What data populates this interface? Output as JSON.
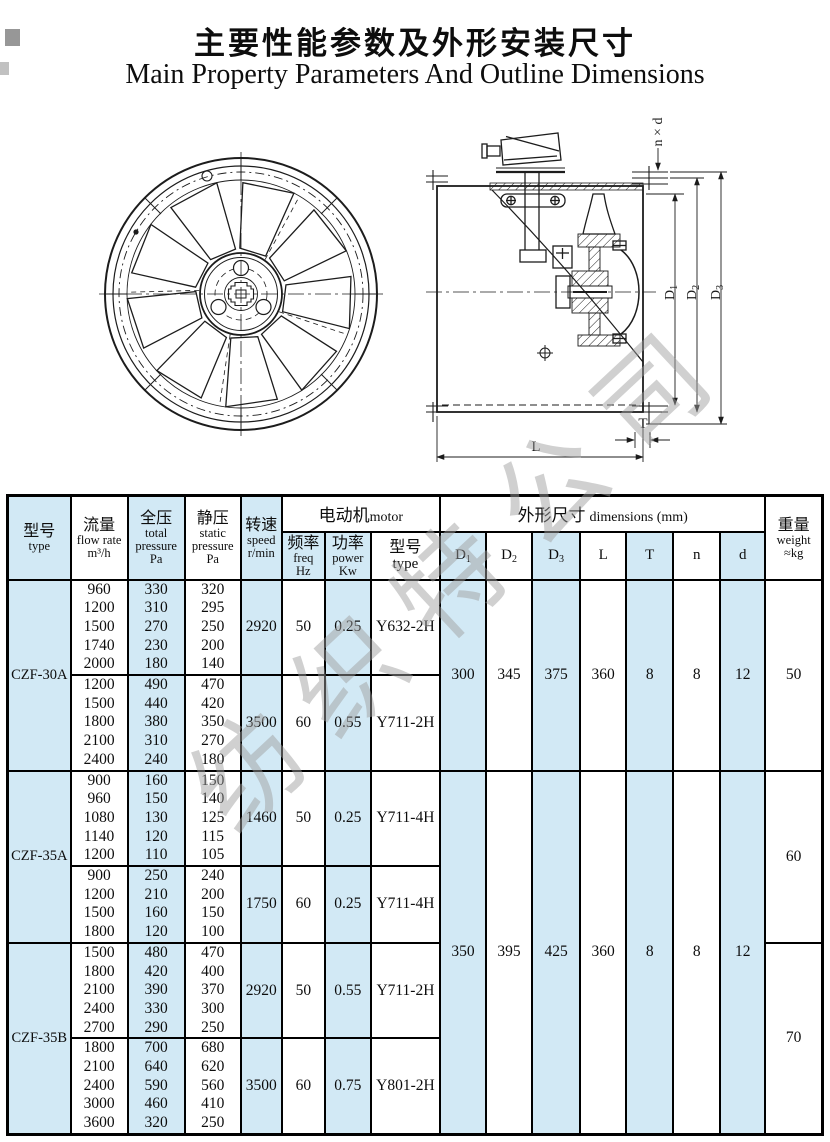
{
  "title": {
    "zh": "主要性能参数及外形安装尺寸",
    "en": "Main Property Parameters And Outline Dimensions"
  },
  "watermark": {
    "text": "纺织特公司"
  },
  "drawing_labels": {
    "nxd": "n × d",
    "l": "L",
    "t": "T"
  },
  "table": {
    "header": {
      "type_zh": "型号",
      "type_en": "type",
      "flow_zh": "流量",
      "flow_en": "flow rate",
      "flow_unit": "m³/h",
      "total_zh": "全压",
      "total_en": "total pressure",
      "total_unit": "Pa",
      "static_zh": "静压",
      "static_en": "static pressure",
      "static_unit": "Pa",
      "speed_zh": "转速",
      "speed_en": "speed",
      "speed_unit": "r/min",
      "motor_zh": "电动机",
      "motor_en": "motor",
      "freq_zh": "频率",
      "freq_en": "freq",
      "freq_unit": "Hz",
      "power_zh": "功率",
      "power_en": "power",
      "power_unit": "Kw",
      "mtype_zh": "型号",
      "mtype_en": "type",
      "dims_zh": "外形尺寸",
      "dims_en": "dimensions  (mm)",
      "d1": {
        "base": "D",
        "sub": "1"
      },
      "d2": {
        "base": "D",
        "sub": "2"
      },
      "d3": {
        "base": "D",
        "sub": "3"
      },
      "l": "L",
      "t": "T",
      "n": "n",
      "d": "d",
      "weight_zh": "重量",
      "weight_en": "weight",
      "weight_unit": "≈kg"
    },
    "groups": [
      {
        "type": "CZF-30A",
        "weight": 50,
        "blocks": [
          {
            "flow": [
              960,
              1200,
              1500,
              1740,
              2000
            ],
            "total": [
              330,
              310,
              270,
              230,
              180
            ],
            "static": [
              320,
              295,
              250,
              200,
              140
            ],
            "speed": 2920,
            "freq": 50,
            "power": "0.25",
            "motor": "Y632-2H"
          },
          {
            "flow": [
              1200,
              1500,
              1800,
              2100,
              2400
            ],
            "total": [
              490,
              440,
              380,
              310,
              240
            ],
            "static": [
              470,
              420,
              350,
              270,
              180
            ],
            "speed": 3500,
            "freq": 60,
            "power": "0.55",
            "motor": "Y711-2H"
          }
        ]
      },
      {
        "type": "CZF-35A",
        "weight": 60,
        "blocks": [
          {
            "flow": [
              900,
              960,
              1080,
              1140,
              1200
            ],
            "total": [
              160,
              150,
              130,
              120,
              110
            ],
            "static": [
              150,
              140,
              125,
              115,
              105
            ],
            "speed": 1460,
            "freq": 50,
            "power": "0.25",
            "motor": "Y711-4H"
          },
          {
            "flow": [
              900,
              1200,
              1500,
              1800
            ],
            "total": [
              250,
              210,
              160,
              120
            ],
            "static": [
              240,
              200,
              150,
              100
            ],
            "speed": 1750,
            "freq": 60,
            "power": "0.25",
            "motor": "Y711-4H"
          }
        ]
      },
      {
        "type": "CZF-35B",
        "weight": 70,
        "blocks": [
          {
            "flow": [
              1500,
              1800,
              2100,
              2400,
              2700
            ],
            "total": [
              480,
              420,
              390,
              330,
              290
            ],
            "static": [
              470,
              400,
              370,
              300,
              250
            ],
            "speed": 2920,
            "freq": 50,
            "power": "0.55",
            "motor": "Y711-2H"
          },
          {
            "flow": [
              1800,
              2100,
              2400,
              3000,
              3600
            ],
            "total": [
              700,
              640,
              590,
              460,
              320
            ],
            "static": [
              680,
              620,
              560,
              410,
              250
            ],
            "speed": 3500,
            "freq": 60,
            "power": "0.75",
            "motor": "Y801-2H"
          }
        ]
      }
    ],
    "dims": [
      {
        "d1": 300,
        "d2": 345,
        "d3": 375,
        "l": 360,
        "t": 8,
        "n": 8,
        "d": 12
      },
      {
        "d1": 350,
        "d2": 395,
        "d3": 425,
        "l": 360,
        "t": 8,
        "n": 8,
        "d": 12
      }
    ]
  }
}
